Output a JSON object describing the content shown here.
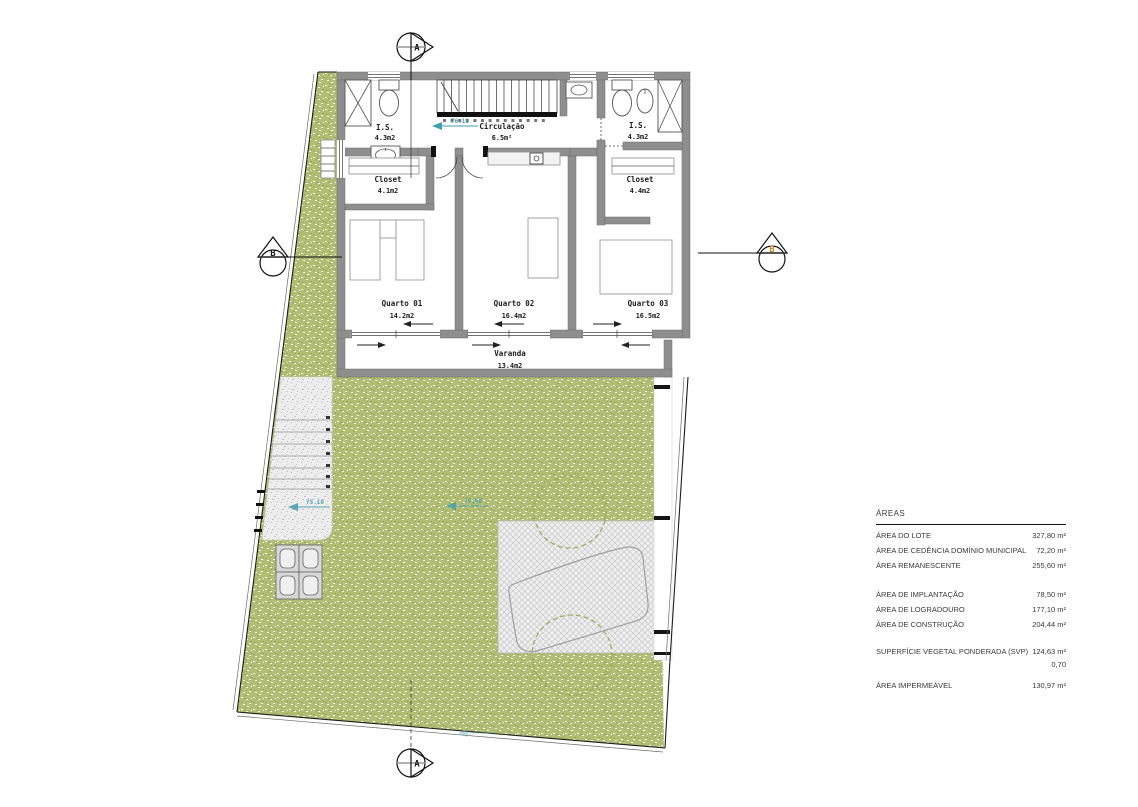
{
  "plan": {
    "section_markers": {
      "top": "A",
      "bottom": "A",
      "left": "B",
      "right": "B"
    },
    "levels": {
      "floor": "76.19",
      "path": "75.10",
      "garden": "75.60"
    },
    "rooms": {
      "bath_left": {
        "name": "I.S.",
        "area": "4.3m2"
      },
      "circulation": {
        "name": "Circulação",
        "area": "6.5m²"
      },
      "bath_right": {
        "name": "I.S.",
        "area": "4.3m2"
      },
      "closet_left": {
        "name": "Closet",
        "area": "4.1m2"
      },
      "closet_right": {
        "name": "Closet",
        "area": "4.4m2"
      },
      "bedroom1": {
        "name": "Quarto 01",
        "area": "14.2m2"
      },
      "bedroom2": {
        "name": "Quarto 02",
        "area": "16.4m2"
      },
      "bedroom3": {
        "name": "Quarto 03",
        "area": "16.5m2"
      },
      "balcony": {
        "name": "Varanda",
        "area": "13.4m2"
      }
    }
  },
  "areas_table": {
    "title": "ÁREAS",
    "rows": [
      {
        "label": "ÁREA DO LOTE",
        "value": "327,80 m²"
      },
      {
        "label": "ÁREA DE CEDÊNCIA DOMÍNIO MUNICIPAL",
        "value": "72,20 m²"
      },
      {
        "label": "ÁREA REMANESCENTE",
        "value": "255,60 m²"
      },
      {
        "label": "ÁREA DE IMPLANTAÇÃO",
        "value": "78,50 m²"
      },
      {
        "label": "ÁREA DE LOGRADOURO",
        "value": "177,10 m²"
      },
      {
        "label": "ÁREA DE CONSTRUÇÃO",
        "value": "204,44 m²"
      },
      {
        "label": "SUPERFÍCIE VEGETAL PONDERADA (SVP)",
        "value": "124,63 m²"
      },
      {
        "label": "",
        "value": "0,70"
      },
      {
        "label": "ÁREA IMPERMEÁVEL",
        "value": "130,97 m²"
      }
    ]
  },
  "colors": {
    "grass": "#b0bd72",
    "wall": "#8e8e8e",
    "level_marker": "#3f9fae",
    "section_letter_accent": "#c8871f"
  }
}
